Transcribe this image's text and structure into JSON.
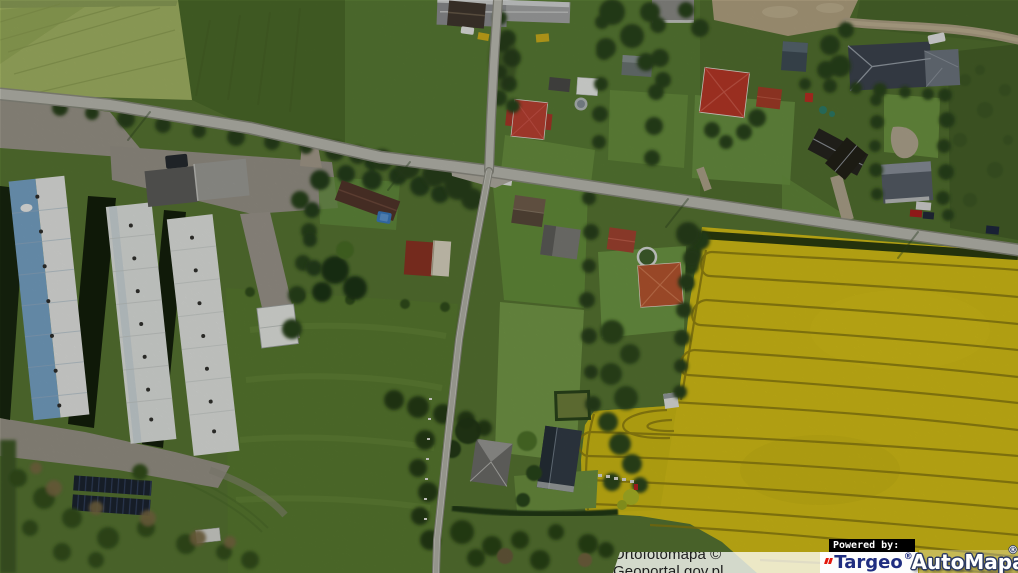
{
  "attribution": {
    "text": "Ortofotomapa © Geoportal.gov.pl"
  },
  "branding": {
    "powered_by_label": "Powered by:",
    "targeo": {
      "name": "Targeo",
      "registered_mark": "®",
      "text_color": "#1f2d80",
      "accent_color": "#e3170d",
      "background_color": "#ffffff"
    },
    "automapa": {
      "name": "AutoMapa",
      "registered_mark": "®",
      "text_color": "#ffffff",
      "outline_color": "#2c3a63"
    }
  },
  "map": {
    "type": "aerial-orthophoto",
    "palette": {
      "field_green_dark": "#4d6c2b",
      "field_green_light": "#a6b766",
      "lawn_green": "#6b9240",
      "rapeseed_yellow": "#d7c217",
      "road_gray": "#bdbdb3",
      "barn_roof_blue": "#79a5c9",
      "barn_roof_white": "#e7e9e6",
      "house_roof_red": "#bf4333",
      "house_roof_orange": "#bb5731",
      "house_roof_slate": "#3e4550"
    },
    "features": [
      "rural crossroads village",
      "three long farm barns",
      "rapeseed field with tractor tracks",
      "detached houses with gardens",
      "solar panel array"
    ]
  }
}
